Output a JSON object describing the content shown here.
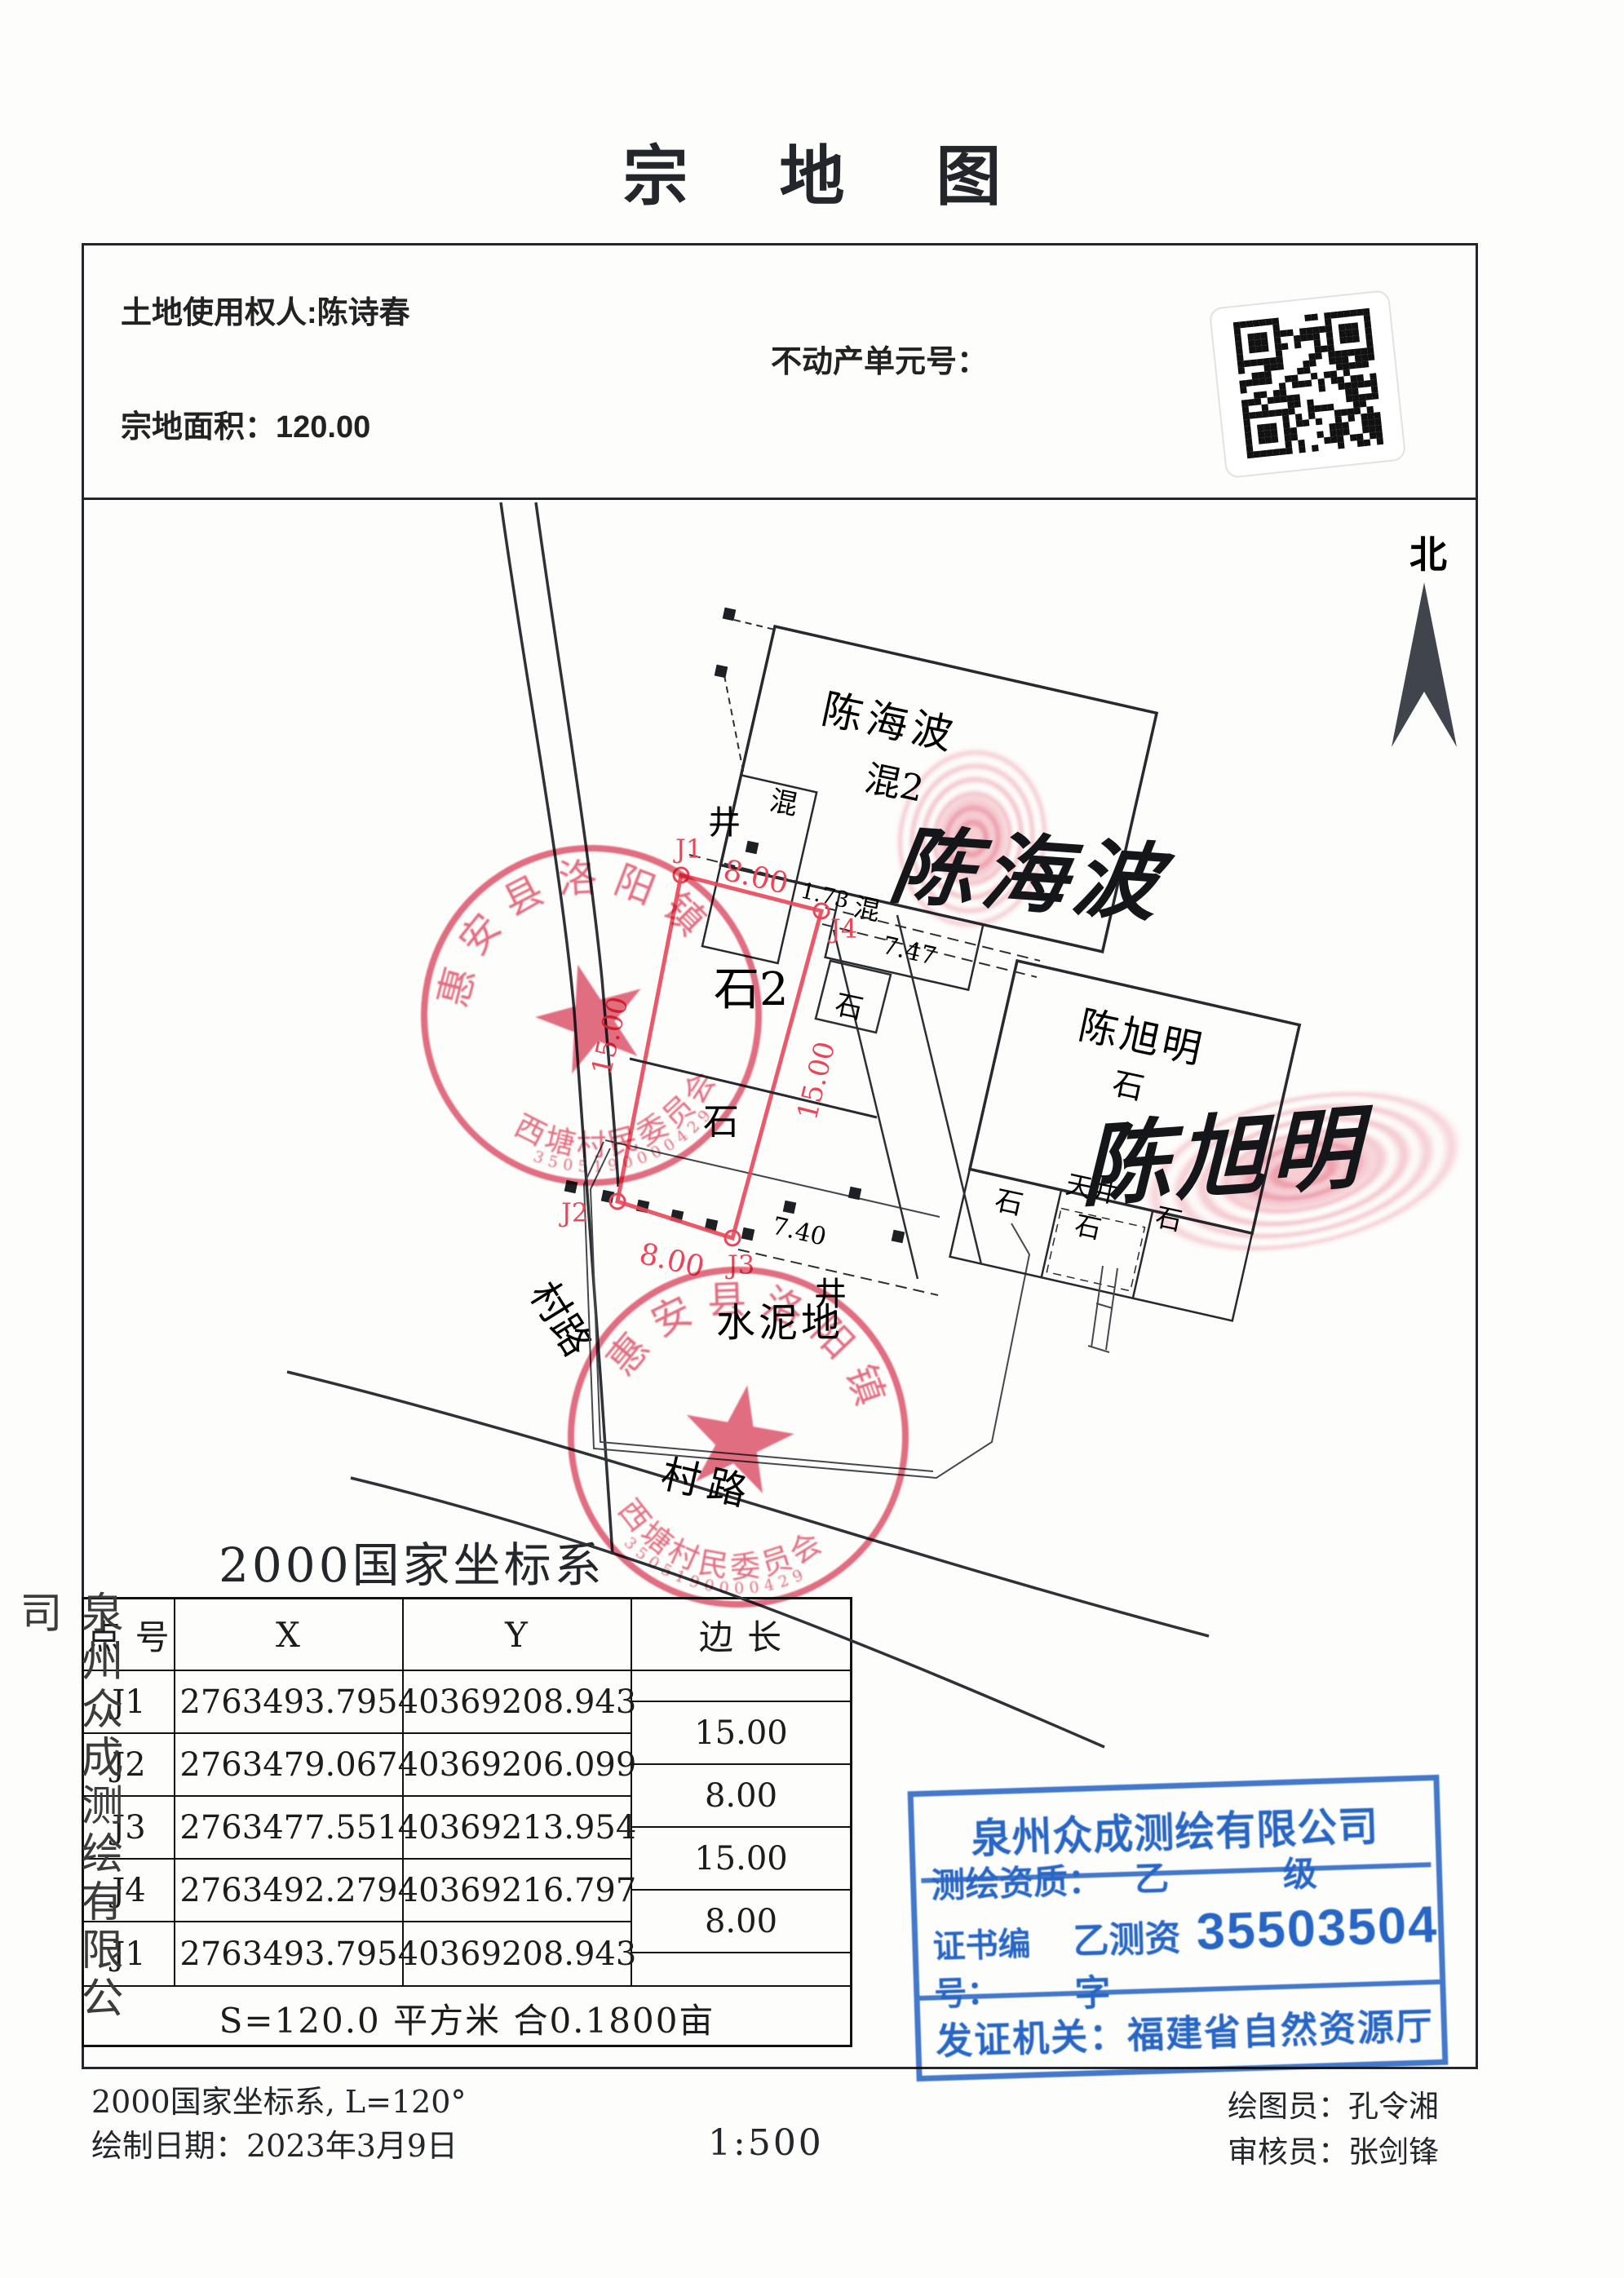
{
  "title": "宗 地 图",
  "header": {
    "owner": "土地使用权人:陈诗春",
    "unit_label": "不动产单元号：",
    "area": "宗地面积：120.00"
  },
  "compass": {
    "north": "北"
  },
  "map": {
    "bld1_name": "陈海波",
    "bld1_type": "混2",
    "bld2_name": "陈旭明",
    "bld2_type": "石",
    "hun": "混",
    "shi": "石",
    "shi2": "石2",
    "tianjing": "天井",
    "cement": "水泥地",
    "well": "井",
    "road": "村路",
    "j1": "J1",
    "j2": "J2",
    "j3": "J3",
    "j4": "J4",
    "edge_8": "8.00",
    "edge_15": "15.00",
    "dim_173": "1.73",
    "dim_747": "7.47",
    "dim_740": "7.40"
  },
  "signatures": {
    "sig1": "陈海波",
    "sig2": "陈旭明"
  },
  "village_stamp": {
    "arc_top": "惠安县洛阳镇",
    "arc_bottom": "西塘村民委员会",
    "serial": "3505190000429"
  },
  "side_text": "泉州众成测绘有限公司",
  "table": {
    "title": "2000国家坐标系",
    "headers": [
      "点 号",
      "X",
      "Y",
      "边 长"
    ],
    "rows": [
      {
        "pt": "J1",
        "x": "2763493.795",
        "y": "40369208.943"
      },
      {
        "pt": "J2",
        "x": "2763479.067",
        "y": "40369206.099"
      },
      {
        "pt": "J3",
        "x": "2763477.551",
        "y": "40369213.954"
      },
      {
        "pt": "J4",
        "x": "2763492.279",
        "y": "40369216.797"
      },
      {
        "pt": "J1",
        "x": "2763493.795",
        "y": "40369208.943"
      }
    ],
    "edges": [
      "15.00",
      "8.00",
      "15.00",
      "8.00"
    ],
    "summary": "S=120.0 平方米 合0.1800亩"
  },
  "surveyor_stamp": {
    "company": "泉州众成测绘有限公司",
    "qual_label": "测绘资质：",
    "qual_value": "乙 级",
    "cert_label": "证书编号：",
    "cert_prefix": "乙测资字",
    "cert_number": "35503504",
    "issuer": "发证机关：福建省自然资源厅"
  },
  "footer": {
    "crs": "2000国家坐标系, L=120°",
    "date": "绘制日期：2023年3月9日",
    "scale": "1:500",
    "drafter": "绘图员：孔令湘",
    "reviewer": "审核员：张剑锋"
  }
}
